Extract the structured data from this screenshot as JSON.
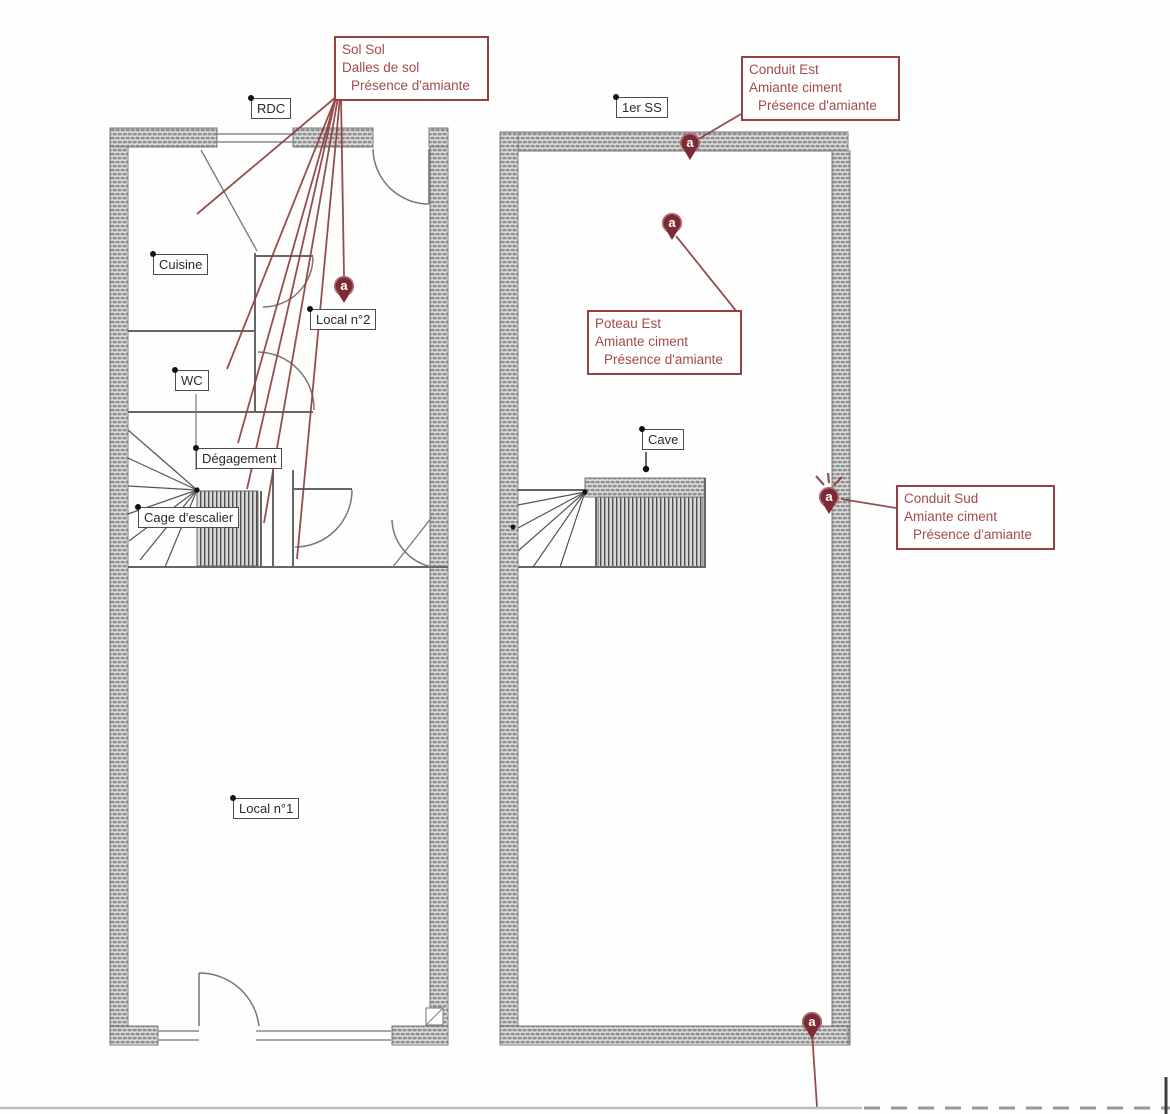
{
  "floors": {
    "left": {
      "label": "RDC"
    },
    "right": {
      "label": "1er SS"
    }
  },
  "rooms": {
    "cuisine": "Cuisine",
    "local2": "Local n°2",
    "wc": "WC",
    "degagement": "Dégagement",
    "cage_escalier": "Cage d'escalier",
    "local1": "Local n°1",
    "cave": "Cave"
  },
  "annotations": {
    "sol_sol": {
      "lines": [
        "Sol Sol",
        "Dalles de sol",
        "Présence d'amiante"
      ]
    },
    "conduit_est": {
      "lines": [
        "Conduit Est",
        "Amiante ciment",
        "Présence d'amiante"
      ]
    },
    "poteau_est": {
      "lines": [
        "Poteau Est",
        "Amiante ciment",
        "Présence d'amiante"
      ]
    },
    "conduit_sud": {
      "lines": [
        "Conduit Sud",
        "Amiante ciment",
        "Présence d'amiante"
      ]
    }
  },
  "marker_letter": "a",
  "colors": {
    "annotation_text": "#a54a4a",
    "annotation_border": "#97403f",
    "marker_fill": "#7c2b35",
    "wall_hatch": "#8f8f8f",
    "line": "#6b6b6b"
  }
}
